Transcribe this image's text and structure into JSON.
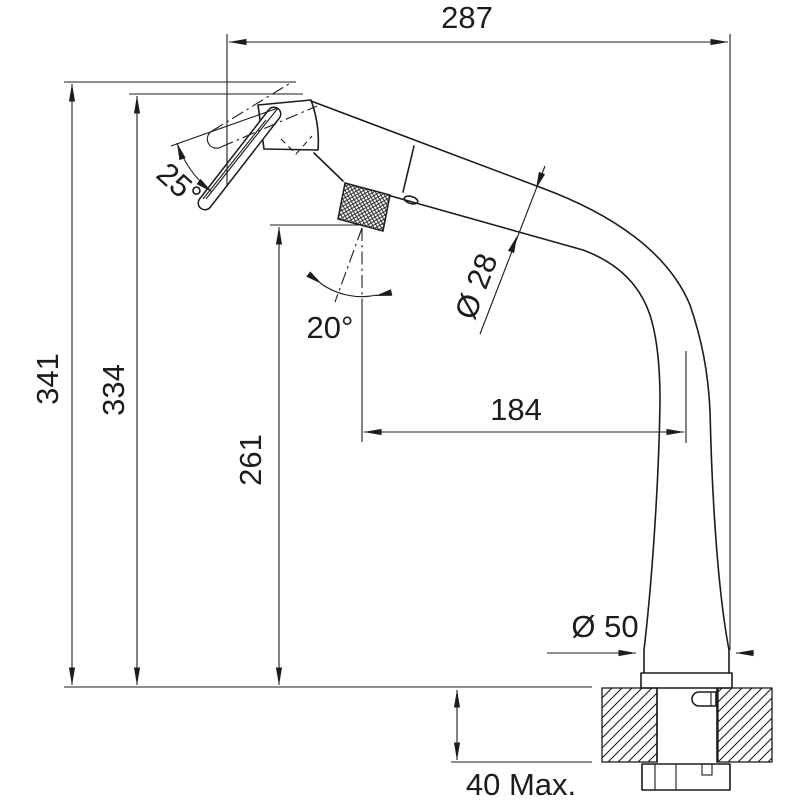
{
  "drawing": {
    "kind": "technical-dimension-drawing",
    "subject": "pull-out kitchen mixer tap, side elevation with installation cross-section",
    "background_color": "#ffffff",
    "line_color": "#1c1c1c"
  },
  "dimensions": {
    "spout_reach": "287",
    "overall_height": "341",
    "head_height": "334",
    "handle_pivot_height": "261",
    "handle_to_spout_axis": "184",
    "spout_tube_diameter": "Ø 28",
    "base_diameter": "Ø 50",
    "max_deck_thickness": "40 Max.",
    "spray_head_tilt_angle": "25°",
    "handle_lever_angle": "20°"
  }
}
